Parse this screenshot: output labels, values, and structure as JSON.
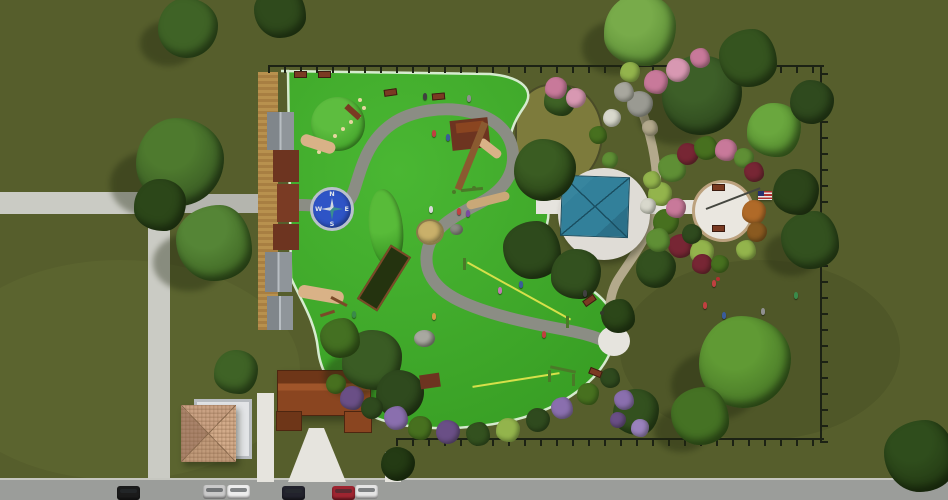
{
  "compass": {
    "n": "N",
    "e": "E",
    "s": "S",
    "w": "W"
  },
  "colors": {
    "grass": "#565e2c",
    "playfield": "#3da62a",
    "playfield_hi": "#4ab733",
    "playfield_edge": "#d6ebcf",
    "path": "#8b8d84",
    "walk": "#cacbc4",
    "walk_dark": "#b4b5ae",
    "walk_white": "#e6e4de",
    "road": "#9b9d9a",
    "curb": "#c6c7c0",
    "gravel": "#b3a98c",
    "boardwalk": "#b8914e",
    "fence": "#1c2214",
    "canopy": "#32809a",
    "canopy_dark": "#1a4f62",
    "pad": "#dfdcd6",
    "plaza": "#eae7e0",
    "plaza_ring": "#bca27e",
    "compass": "#2e54c6",
    "compass_ring": "#b9c0cc",
    "star": "#cfd8e0",
    "star2": "#3a8f8f",
    "gazebo": "#c9a183",
    "gazebo_dark": "#8a6a4e",
    "pergola": "#b8bcc0",
    "pavilion": "#8a4520",
    "pavilion_dark": "#6e3618",
    "pavilion_hi": "#a0552a",
    "bench": "#7a3a22",
    "bench_dark": "#3c1c10",
    "pocket": "#7d7b3c"
  },
  "scene": {
    "trees": [
      {
        "x": 180,
        "y": 162,
        "r": 44,
        "c": "#3a5c24",
        "h": "#4e7a2e",
        "s": 1
      },
      {
        "x": 214,
        "y": 243,
        "r": 38,
        "c": "#426a26",
        "h": "#558536",
        "s": 1
      },
      {
        "x": 160,
        "y": 205,
        "r": 26,
        "c": "#2c4719"
      },
      {
        "x": 188,
        "y": 28,
        "r": 30,
        "c": "#3f6326",
        "s": 1
      },
      {
        "x": 280,
        "y": 12,
        "r": 26,
        "c": "#2f4a1c"
      },
      {
        "x": 640,
        "y": 30,
        "r": 36,
        "c": "#5f9038",
        "h": "#78ab4a",
        "s": 1
      },
      {
        "x": 702,
        "y": 95,
        "r": 40,
        "c": "#2f4a1e",
        "h": "#3d5f28",
        "s": 1
      },
      {
        "x": 748,
        "y": 58,
        "r": 29,
        "c": "#35541f"
      },
      {
        "x": 774,
        "y": 130,
        "r": 27,
        "c": "#568c30",
        "h": "#6aa73e"
      },
      {
        "x": 812,
        "y": 102,
        "r": 22,
        "c": "#2f4a1e"
      },
      {
        "x": 810,
        "y": 240,
        "r": 29,
        "c": "#33511f",
        "s": 1
      },
      {
        "x": 796,
        "y": 192,
        "r": 23,
        "c": "#2c451a"
      },
      {
        "x": 745,
        "y": 362,
        "r": 46,
        "c": "#4a7a28",
        "h": "#609a34",
        "s": 1
      },
      {
        "x": 700,
        "y": 416,
        "r": 29,
        "c": "#457224",
        "s": 1
      },
      {
        "x": 636,
        "y": 412,
        "r": 23,
        "c": "#33511f"
      },
      {
        "x": 545,
        "y": 170,
        "r": 31,
        "c": "#2c4719",
        "h": "#3a5c22"
      },
      {
        "x": 532,
        "y": 250,
        "r": 29,
        "c": "#2e4a1c"
      },
      {
        "x": 576,
        "y": 274,
        "r": 25,
        "c": "#33511f"
      },
      {
        "x": 656,
        "y": 268,
        "r": 20,
        "c": "#33511f"
      },
      {
        "x": 618,
        "y": 316,
        "r": 17,
        "c": "#2c4719"
      },
      {
        "x": 372,
        "y": 360,
        "r": 30,
        "c": "#3a5c24",
        "s": 1
      },
      {
        "x": 400,
        "y": 394,
        "r": 24,
        "c": "#2f4a1e"
      },
      {
        "x": 340,
        "y": 338,
        "r": 20,
        "c": "#447022"
      },
      {
        "x": 236,
        "y": 372,
        "r": 22,
        "c": "#3f6326"
      },
      {
        "x": 398,
        "y": 464,
        "r": 17,
        "c": "#243b14"
      },
      {
        "x": 920,
        "y": 456,
        "r": 36,
        "c": "#243b14",
        "h": "#2f4d1c"
      },
      {
        "x": 560,
        "y": 100,
        "r": 16,
        "c": "#3f6326"
      }
    ],
    "flora": [
      {
        "x": 672,
        "y": 168,
        "r": 14,
        "c": "#5f8f35"
      },
      {
        "x": 660,
        "y": 194,
        "r": 12,
        "c": "#93b44c"
      },
      {
        "x": 666,
        "y": 222,
        "r": 13,
        "c": "#47701f"
      },
      {
        "x": 680,
        "y": 246,
        "r": 12,
        "c": "#772634"
      },
      {
        "x": 702,
        "y": 252,
        "r": 12,
        "c": "#93b44c"
      },
      {
        "x": 688,
        "y": 154,
        "r": 11,
        "c": "#772634"
      },
      {
        "x": 706,
        "y": 148,
        "r": 12,
        "c": "#47701f"
      },
      {
        "x": 726,
        "y": 150,
        "r": 11,
        "c": "#c8799a"
      },
      {
        "x": 744,
        "y": 158,
        "r": 10,
        "c": "#5f8f35"
      },
      {
        "x": 754,
        "y": 172,
        "r": 10,
        "c": "#772634"
      },
      {
        "x": 676,
        "y": 208,
        "r": 10,
        "c": "#c8799a"
      },
      {
        "x": 692,
        "y": 234,
        "r": 10,
        "c": "#2f4a1e"
      },
      {
        "x": 658,
        "y": 240,
        "r": 12,
        "c": "#5f8f35"
      },
      {
        "x": 702,
        "y": 264,
        "r": 10,
        "c": "#772634"
      },
      {
        "x": 720,
        "y": 264,
        "r": 9,
        "c": "#47701f"
      },
      {
        "x": 746,
        "y": 250,
        "r": 10,
        "c": "#93b44c"
      },
      {
        "x": 754,
        "y": 212,
        "r": 12,
        "c": "#b06a28"
      },
      {
        "x": 757,
        "y": 232,
        "r": 10,
        "c": "#8a5a20"
      },
      {
        "x": 652,
        "y": 180,
        "r": 9,
        "c": "#93b44c"
      },
      {
        "x": 648,
        "y": 206,
        "r": 8,
        "c": "#d8d8cc"
      },
      {
        "x": 640,
        "y": 104,
        "r": 13,
        "c": "#9a9a92"
      },
      {
        "x": 624,
        "y": 92,
        "r": 10,
        "c": "#a8a79e"
      },
      {
        "x": 656,
        "y": 82,
        "r": 12,
        "c": "#c8799a"
      },
      {
        "x": 678,
        "y": 70,
        "r": 12,
        "c": "#d898b2"
      },
      {
        "x": 700,
        "y": 58,
        "r": 10,
        "c": "#c8799a"
      },
      {
        "x": 630,
        "y": 72,
        "r": 10,
        "c": "#93b44c"
      },
      {
        "x": 612,
        "y": 118,
        "r": 9,
        "c": "#d8d8cc"
      },
      {
        "x": 650,
        "y": 128,
        "r": 8,
        "c": "#b3a98c"
      },
      {
        "x": 352,
        "y": 398,
        "r": 12,
        "c": "#6a4f86"
      },
      {
        "x": 372,
        "y": 408,
        "r": 11,
        "c": "#2f4a1e"
      },
      {
        "x": 396,
        "y": 418,
        "r": 12,
        "c": "#8a6fae"
      },
      {
        "x": 420,
        "y": 428,
        "r": 12,
        "c": "#47701f"
      },
      {
        "x": 448,
        "y": 432,
        "r": 12,
        "c": "#6a4f86"
      },
      {
        "x": 478,
        "y": 434,
        "r": 12,
        "c": "#33511f"
      },
      {
        "x": 508,
        "y": 430,
        "r": 12,
        "c": "#93b44c"
      },
      {
        "x": 538,
        "y": 420,
        "r": 12,
        "c": "#2f4a1e"
      },
      {
        "x": 562,
        "y": 408,
        "r": 11,
        "c": "#8a6fae"
      },
      {
        "x": 588,
        "y": 394,
        "r": 11,
        "c": "#47701f"
      },
      {
        "x": 336,
        "y": 384,
        "r": 10,
        "c": "#47701f"
      },
      {
        "x": 610,
        "y": 378,
        "r": 10,
        "c": "#2f4a1e"
      },
      {
        "x": 556,
        "y": 88,
        "r": 11,
        "c": "#c8799a"
      },
      {
        "x": 576,
        "y": 98,
        "r": 10,
        "c": "#d898b2"
      },
      {
        "x": 624,
        "y": 400,
        "r": 10,
        "c": "#8a6fae"
      },
      {
        "x": 640,
        "y": 428,
        "r": 9,
        "c": "#9a82bc"
      },
      {
        "x": 618,
        "y": 420,
        "r": 8,
        "c": "#6a4f86"
      },
      {
        "x": 598,
        "y": 135,
        "r": 9,
        "c": "#47701f"
      },
      {
        "x": 610,
        "y": 160,
        "r": 8,
        "c": "#5f8f35"
      }
    ],
    "equipment": [
      {
        "t": "circle",
        "x": 311,
        "y": 97,
        "w": 54,
        "h": 54,
        "c": "#45a52c",
        "c2": "#5dbd3f",
        "name": "climbing-dome"
      },
      {
        "t": "dot",
        "x": 358,
        "y": 98,
        "c": "#e6d6a0"
      },
      {
        "t": "dot",
        "x": 362,
        "y": 106,
        "c": "#e6d6a0"
      },
      {
        "t": "dot",
        "x": 357,
        "y": 114,
        "c": "#e6d6a0"
      },
      {
        "t": "dot",
        "x": 349,
        "y": 120,
        "c": "#e6d6a0"
      },
      {
        "t": "dot",
        "x": 341,
        "y": 127,
        "c": "#e6d6a0"
      },
      {
        "t": "dot",
        "x": 333,
        "y": 134,
        "c": "#e6d6a0"
      },
      {
        "t": "dot",
        "x": 325,
        "y": 141,
        "c": "#e6d6a0"
      },
      {
        "t": "dot",
        "x": 317,
        "y": 150,
        "c": "#e6d6a0"
      },
      {
        "t": "box",
        "x": 344,
        "y": 109,
        "w": 18,
        "h": 6,
        "rot": 42,
        "c": "#7a3a22",
        "name": "log-step"
      },
      {
        "t": "circle",
        "x": 369,
        "y": 189,
        "w": 34,
        "h": 78,
        "rot": -6,
        "c": "#3f9e28",
        "c2": "#58bb39",
        "name": "play-mound"
      },
      {
        "t": "box",
        "x": 267,
        "y": 112,
        "w": 27,
        "h": 38,
        "c": "#9aa0a5",
        "g": 1,
        "name": "shade-roof"
      },
      {
        "t": "box",
        "x": 265,
        "y": 252,
        "w": 27,
        "h": 40,
        "c": "#9aa0a5",
        "g": 1,
        "name": "shade-roof"
      },
      {
        "t": "box",
        "x": 267,
        "y": 296,
        "w": 26,
        "h": 34,
        "c": "#9aa0a5",
        "g": 1,
        "name": "shade-roof"
      },
      {
        "t": "box",
        "x": 273,
        "y": 150,
        "w": 26,
        "h": 32,
        "c": "#6d3420",
        "name": "ramp-deck"
      },
      {
        "t": "box",
        "x": 277,
        "y": 184,
        "w": 22,
        "h": 38,
        "c": "#7a3b24",
        "name": "ramp-deck"
      },
      {
        "t": "box",
        "x": 273,
        "y": 224,
        "w": 26,
        "h": 26,
        "c": "#6d3420",
        "name": "ramp-deck"
      },
      {
        "t": "box",
        "x": 300,
        "y": 138,
        "w": 36,
        "h": 12,
        "rot": 18,
        "c": "#d9b287",
        "r": 6,
        "name": "slide"
      },
      {
        "t": "box",
        "x": 298,
        "y": 288,
        "w": 46,
        "h": 13,
        "rot": 10,
        "c": "#d9b287",
        "r": 6,
        "name": "slide"
      },
      {
        "t": "box",
        "x": 451,
        "y": 119,
        "w": 38,
        "h": 30,
        "rot": -6,
        "c": "#6d3420",
        "name": "play-fort"
      },
      {
        "t": "box",
        "x": 456,
        "y": 122,
        "w": 28,
        "h": 10,
        "rot": -6,
        "c": "#8a4520"
      },
      {
        "t": "box",
        "x": 477,
        "y": 144,
        "w": 26,
        "h": 9,
        "rot": 38,
        "c": "#d9b287",
        "r": 4,
        "name": "slide"
      },
      {
        "t": "box",
        "x": 468,
        "y": 120,
        "w": 7,
        "h": 72,
        "rot": 22,
        "c": "#8a5a30",
        "name": "rope-bridge"
      },
      {
        "t": "box",
        "x": 461,
        "y": 188,
        "w": 22,
        "h": 3,
        "rot": -6,
        "c": "#4a7a28",
        "name": "balance-bar"
      },
      {
        "t": "dot",
        "x": 452,
        "y": 190,
        "c": "#4a7a28"
      },
      {
        "t": "dot",
        "x": 472,
        "y": 186,
        "c": "#4a7a28"
      },
      {
        "t": "box",
        "x": 372,
        "y": 246,
        "w": 20,
        "h": 60,
        "rot": 32,
        "c": "#24330f",
        "bc": "#7a4a28",
        "name": "climbing-net"
      },
      {
        "t": "box",
        "x": 330,
        "y": 300,
        "w": 18,
        "h": 3,
        "rot": 28,
        "c": "#7a4a28"
      },
      {
        "t": "box",
        "x": 320,
        "y": 312,
        "w": 15,
        "h": 3,
        "rot": -18,
        "c": "#7a4a28"
      },
      {
        "t": "box",
        "x": 460,
        "y": 290,
        "w": 118,
        "h": 2,
        "rot": 29,
        "c": "#d6e04a",
        "name": "zipline-cable"
      },
      {
        "t": "box",
        "x": 463,
        "y": 258,
        "w": 3,
        "h": 12,
        "c": "#4a7a28"
      },
      {
        "t": "box",
        "x": 566,
        "y": 316,
        "w": 3,
        "h": 12,
        "c": "#4a7a28"
      },
      {
        "t": "box",
        "x": 472,
        "y": 379,
        "w": 88,
        "h": 2,
        "rot": -9,
        "c": "#d6e04a",
        "name": "zipline-cable"
      },
      {
        "t": "box",
        "x": 420,
        "y": 374,
        "w": 20,
        "h": 14,
        "rot": -8,
        "c": "#6d3420",
        "name": "zipline-platform"
      },
      {
        "t": "box",
        "x": 550,
        "y": 368,
        "w": 26,
        "h": 3,
        "rot": 12,
        "c": "#4a7a28"
      },
      {
        "t": "box",
        "x": 548,
        "y": 370,
        "w": 3,
        "h": 12,
        "c": "#4a7a28"
      },
      {
        "t": "box",
        "x": 572,
        "y": 374,
        "w": 3,
        "h": 12,
        "c": "#4a7a28"
      },
      {
        "t": "circle",
        "x": 416,
        "y": 219,
        "w": 24,
        "h": 22,
        "c": "#c9b06a",
        "bc": "#8a7a4a",
        "name": "sand-circle"
      },
      {
        "t": "circle",
        "x": 414,
        "y": 330,
        "w": 21,
        "h": 17,
        "c": "#8c8c84",
        "c2": "#a8a8a0",
        "name": "boulder"
      },
      {
        "t": "circle",
        "x": 450,
        "y": 224,
        "w": 13,
        "h": 11,
        "c": "#8c8c84",
        "name": "boulder"
      },
      {
        "t": "box",
        "x": 466,
        "y": 196,
        "w": 44,
        "h": 9,
        "rot": -14,
        "c": "#c9a878",
        "r": 5,
        "name": "balance-log"
      },
      {
        "t": "dot",
        "x": 600,
        "y": 311,
        "c": "#333a2a",
        "name": "trash-bin"
      },
      {
        "t": "dot",
        "x": 716,
        "y": 277,
        "c": "#b03030",
        "name": "drinking-fountain"
      }
    ],
    "benches": [
      {
        "x": 294,
        "y": 71,
        "rot": 0
      },
      {
        "x": 318,
        "y": 71,
        "rot": 0
      },
      {
        "x": 384,
        "y": 89,
        "rot": -8
      },
      {
        "x": 432,
        "y": 93,
        "rot": -5
      },
      {
        "x": 583,
        "y": 297,
        "rot": -35
      },
      {
        "x": 589,
        "y": 369,
        "rot": 22
      },
      {
        "x": 712,
        "y": 184,
        "rot": 0
      },
      {
        "x": 712,
        "y": 225,
        "rot": 0
      }
    ],
    "people": [
      {
        "x": 432,
        "y": 130,
        "c": "#c04040"
      },
      {
        "x": 446,
        "y": 134,
        "c": "#3a5c9a"
      },
      {
        "x": 429,
        "y": 206,
        "c": "#d8d8d8"
      },
      {
        "x": 457,
        "y": 208,
        "c": "#c04040"
      },
      {
        "x": 423,
        "y": 93,
        "c": "#404040"
      },
      {
        "x": 467,
        "y": 95,
        "c": "#909090"
      },
      {
        "x": 519,
        "y": 281,
        "c": "#3a5c9a"
      },
      {
        "x": 498,
        "y": 287,
        "c": "#c07ab0"
      },
      {
        "x": 542,
        "y": 331,
        "c": "#c04040"
      },
      {
        "x": 352,
        "y": 311,
        "c": "#3a8a4a"
      },
      {
        "x": 432,
        "y": 313,
        "c": "#d0a040"
      },
      {
        "x": 583,
        "y": 290,
        "c": "#404040"
      },
      {
        "x": 703,
        "y": 302,
        "c": "#c04040"
      },
      {
        "x": 722,
        "y": 312,
        "c": "#3a5c9a"
      },
      {
        "x": 761,
        "y": 308,
        "c": "#909090"
      },
      {
        "x": 794,
        "y": 292,
        "c": "#3a8a4a"
      },
      {
        "x": 712,
        "y": 280,
        "c": "#c04040"
      },
      {
        "x": 466,
        "y": 210,
        "c": "#7a4aa0"
      }
    ],
    "cars": [
      {
        "x": 117,
        "y": 486,
        "c": "#1b1b1b"
      },
      {
        "x": 203,
        "y": 485,
        "c": "#c9c9c9"
      },
      {
        "x": 227,
        "y": 485,
        "c": "#ededed"
      },
      {
        "x": 282,
        "y": 486,
        "c": "#22222c"
      },
      {
        "x": 332,
        "y": 486,
        "c": "#9e2430"
      },
      {
        "x": 355,
        "y": 485,
        "c": "#e4e4e4"
      }
    ]
  }
}
